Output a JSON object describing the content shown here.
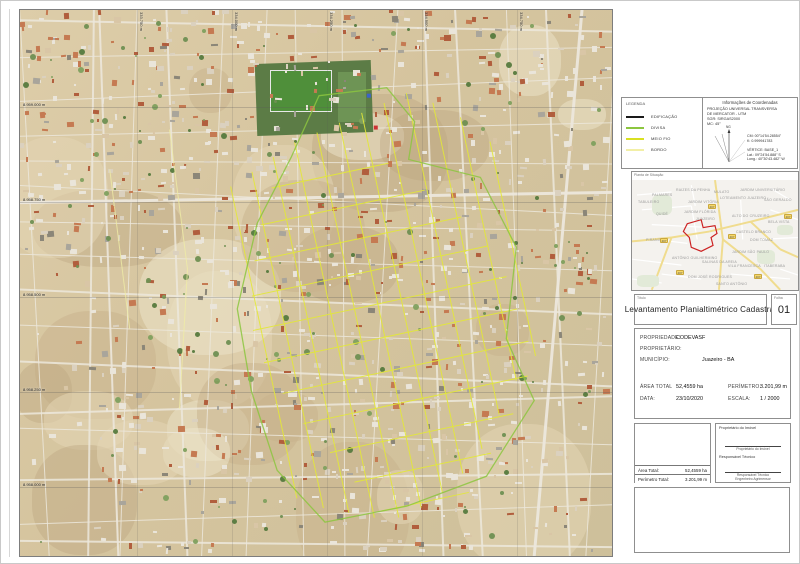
{
  "legend": {
    "title": "LEGENDA",
    "items": [
      {
        "label": "EDIFICAÇÃO",
        "color": "#1a1a1a"
      },
      {
        "label": "DIVISA",
        "color": "#8CC63F"
      },
      {
        "label": "MEIO FIO",
        "color": "#D9E021"
      },
      {
        "label": "BORDO",
        "color": "#F2EFA6"
      }
    ]
  },
  "coordinates_box": {
    "title": "Informações de Coordenadas",
    "lines": [
      "PROJEÇÃO UNIVERSAL TRANSVERSA",
      "DE MERCATOR - UTM",
      "SGR: SIRGAS2000",
      "MC: 45°"
    ],
    "north_label": "NG",
    "annotation": {
      "cm": "CM: 00°14'54.28554\"",
      "k": "K: 0.999941783",
      "vertex": "VÉRTICE: BASE_1",
      "lat": "Lat.: 09°24'54.888\" S",
      "long": "Long.: 40°30'43.482\" W"
    }
  },
  "situacao": {
    "title": "Planta de Situação",
    "highway": "407",
    "polygon_color": "#CC2222",
    "labels": [
      {
        "t": "PALMARES",
        "x": 20,
        "y": 13
      },
      {
        "t": "RAIZES DA PENHA",
        "x": 44,
        "y": 8
      },
      {
        "t": "MULATO",
        "x": 82,
        "y": 10
      },
      {
        "t": "JARDIM UNIVERSITÁRIO",
        "x": 108,
        "y": 8
      },
      {
        "t": "JARDIM VITÓRIA",
        "x": 56,
        "y": 20
      },
      {
        "t": "LOTEAMENTO JUAZEIRO",
        "x": 88,
        "y": 16
      },
      {
        "t": "SÃO GERALDO",
        "x": 132,
        "y": 18
      },
      {
        "t": "TABULEIRO",
        "x": 6,
        "y": 20
      },
      {
        "t": "QUIDÉ",
        "x": 24,
        "y": 32
      },
      {
        "t": "JARDIM FLÓRIDA",
        "x": 52,
        "y": 30
      },
      {
        "t": "JUAZEIRO",
        "x": 64,
        "y": 37
      },
      {
        "t": "ALTO DO CRUZEIRO",
        "x": 100,
        "y": 34
      },
      {
        "t": "BELA VISTA",
        "x": 136,
        "y": 40
      },
      {
        "t": "PIRANGA",
        "x": 14,
        "y": 58
      },
      {
        "t": "CASTELO BRANCO",
        "x": 104,
        "y": 50
      },
      {
        "t": "DOM TOMAZ",
        "x": 118,
        "y": 58
      },
      {
        "t": "JARDIM SÃO PAULO",
        "x": 100,
        "y": 70
      },
      {
        "t": "ANTÔNIO GUILHERMINO",
        "x": 40,
        "y": 76
      },
      {
        "t": "SALINAS DA AREIA",
        "x": 70,
        "y": 80
      },
      {
        "t": "VILA FRANCESCA",
        "x": 96,
        "y": 84
      },
      {
        "t": "ITABERABA",
        "x": 132,
        "y": 84
      },
      {
        "t": "DOM JOSÉ RODRIGUES",
        "x": 56,
        "y": 95
      },
      {
        "t": "SANTO ANTÔNIO",
        "x": 84,
        "y": 102
      }
    ]
  },
  "map": {
    "grid": {
      "northings": [
        "8.959.000 m",
        "8.958.750 m",
        "8.958.500 m",
        "8.958.250 m",
        "8.958.000 m"
      ],
      "eastings": [
        "333.750 m",
        "334.000 m",
        "334.250 m",
        "334.500 m",
        "334.750 m"
      ]
    },
    "overlay_colors": {
      "meio_fio": "#E3E838",
      "divisa": "#8CC63F",
      "bordo": "#F0EDA6",
      "marker_blue": "#3B63C8",
      "marker_red": "#CC3333"
    }
  },
  "title_block": {
    "label": "Título",
    "title": "Levantamento Planialtimétrico Cadastral",
    "sheet_label": "Folha",
    "sheet_number": "01"
  },
  "info_block": {
    "propriedade_label": "PROPRIEDADE:",
    "propriedade": "CODEVASF",
    "proprietario_label": "PROPRIETÁRIO:",
    "proprietario": "",
    "municipio_label": "MUNICÍPIO:",
    "municipio": "Juazeiro - BA",
    "area_label": "ÁREA TOTAL",
    "area": "52,4559 ha",
    "perimetro_label": "PERÍMETRO:",
    "perimetro": "3.201,99 m",
    "data_label": "DATA:",
    "data": "23/10/2020",
    "escala_label": "ESCALA:",
    "escala": "1 / 2000"
  },
  "areas_box": {
    "area_label": "Área Total:",
    "area": "52,4559 ha",
    "perimetro_label": "Perímetro Total:",
    "perimetro": "3.201,99 m"
  },
  "signature_box": {
    "owner_label": "Proprietário do Imóvel",
    "owner_caption": "Proprietário do Imóvel",
    "tech_label": "Responsável Técnico",
    "tech_caption1": "Responsável Técnico",
    "tech_caption2": "Engenheiro Agrimensor"
  }
}
